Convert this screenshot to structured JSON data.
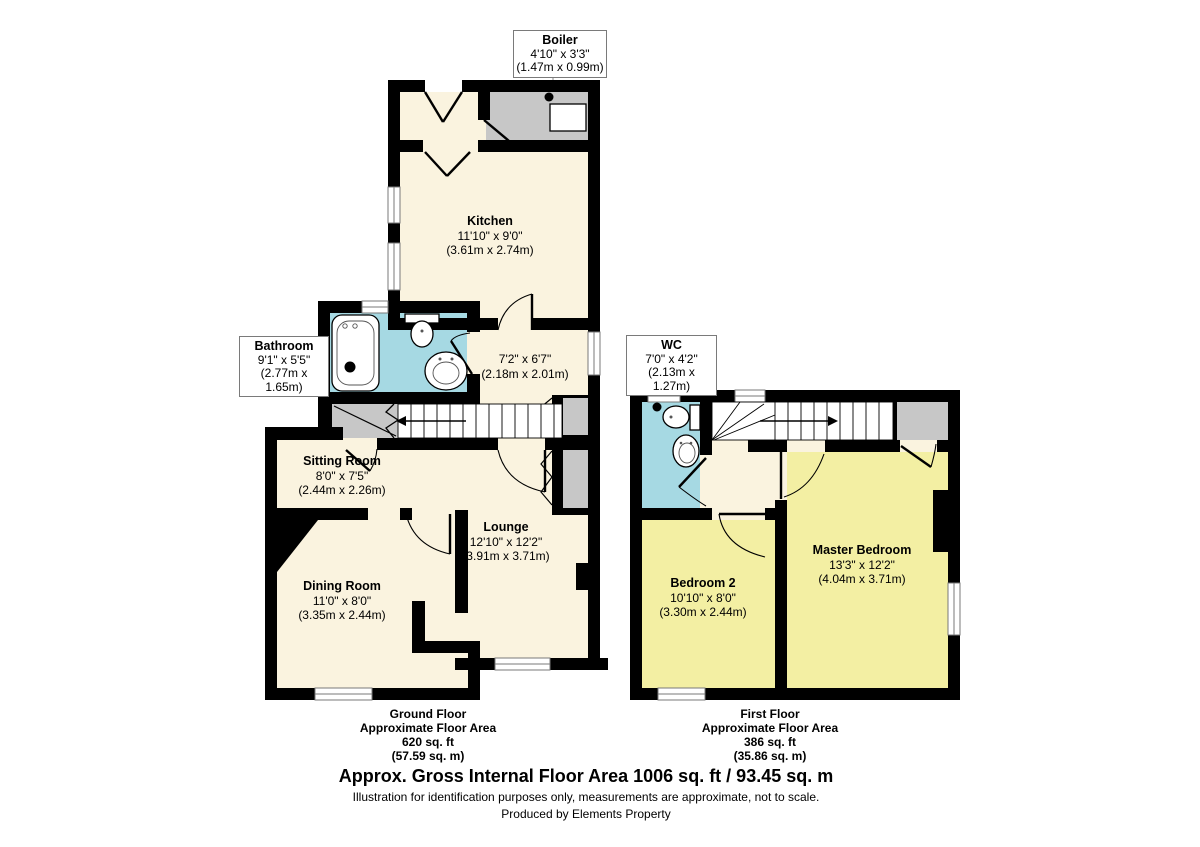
{
  "plan": {
    "boiler": {
      "name": "Boiler",
      "imperial": "4'10\" x 3'3\"",
      "metric": "(1.47m x 0.99m)"
    },
    "kitchen": {
      "name": "Kitchen",
      "imperial": "11'10\" x 9'0\"",
      "metric": "(3.61m x 2.74m)"
    },
    "bathroom": {
      "name": "Bathroom",
      "imperial": "9'1\" x 5'5\"",
      "metric": "(2.77m x 1.65m)"
    },
    "hall": {
      "imperial": "7'2\" x 6'7\"",
      "metric": "(2.18m x 2.01m)"
    },
    "sitting_room": {
      "name": "Sitting Room",
      "imperial": "8'0\" x 7'5\"",
      "metric": "(2.44m x 2.26m)"
    },
    "lounge": {
      "name": "Lounge",
      "imperial": "12'10\" x 12'2\"",
      "metric": "(3.91m x 3.71m)"
    },
    "dining_room": {
      "name": "Dining Room",
      "imperial": "11'0\" x 8'0\"",
      "metric": "(3.35m x 2.44m)"
    },
    "wc": {
      "name": "WC",
      "imperial": "7'0\" x 4'2\"",
      "metric": "(2.13m x 1.27m)"
    },
    "bedroom2": {
      "name": "Bedroom 2",
      "imperial": "10'10\" x 8'0\"",
      "metric": "(3.30m x 2.44m)"
    },
    "master_bedroom": {
      "name": "Master Bedroom",
      "imperial": "13'3\" x 12'2\"",
      "metric": "(4.04m x 3.71m)"
    }
  },
  "captions": {
    "ground": {
      "title": "Ground Floor",
      "line2": "Approximate Floor Area",
      "line3": "620 sq. ft",
      "line4": "(57.59 sq. m)"
    },
    "first": {
      "title": "First Floor",
      "line2": "Approximate Floor Area",
      "line3": "386 sq. ft",
      "line4": "(35.86 sq. m)"
    }
  },
  "footer": {
    "title": "Approx. Gross Internal Floor Area 1006 sq. ft / 93.45 sq. m",
    "disclaimer": "Illustration for identification purposes only, measurements are approximate, not to scale.",
    "credit": "Produced by Elements Property"
  },
  "colors": {
    "floor_cream": "#faf3df",
    "floor_yellow": "#f3efa3",
    "floor_blue": "#a6d9e3",
    "storage_gray": "#c7c7c7",
    "wall": "#000000"
  }
}
